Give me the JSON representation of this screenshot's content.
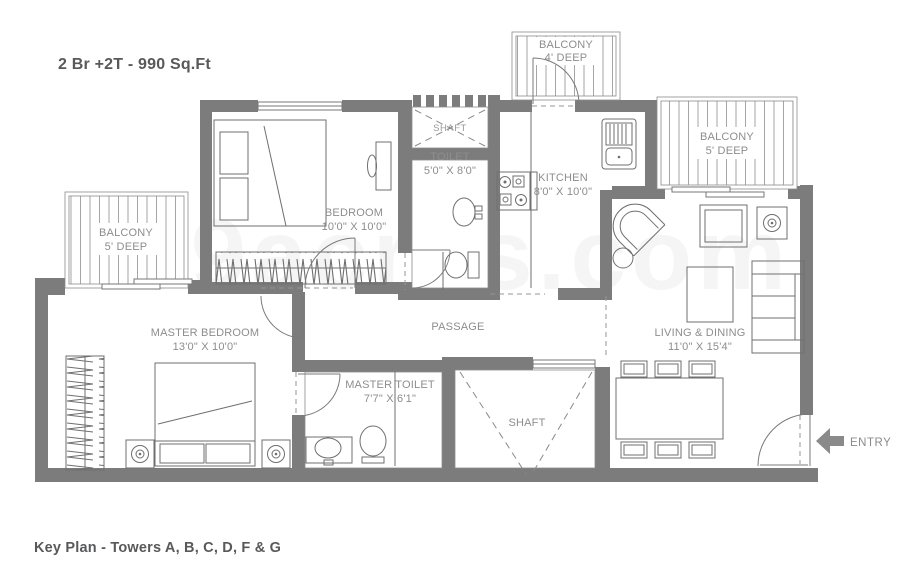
{
  "title": "2 Br +2T - 990 Sq.Ft",
  "footer": "Key Plan - Towers A, B, C, D, F & G",
  "watermark": "99acres.com",
  "entry": {
    "label": "ENTRY"
  },
  "rooms": {
    "bedroom": {
      "name": "BEDROOM",
      "dims": "10'0\" X 10'0\""
    },
    "toilet": {
      "name": "TOILET",
      "dims": "5'0\" X 8'0\""
    },
    "kitchen": {
      "name": "KITCHEN",
      "dims": "8'0\" X 10'0\""
    },
    "master_bedroom": {
      "name": "MASTER BEDROOM",
      "dims": "13'0\" X 10'0\""
    },
    "master_toilet": {
      "name": "MASTER TOILET",
      "dims": "7'7\" X 6'1\""
    },
    "living_dining": {
      "name": "LIVING & DINING",
      "dims": "11'0\" X 15'4\""
    },
    "balcony_top": {
      "name": "BALCONY",
      "dims": "4' DEEP"
    },
    "balcony_right": {
      "name": "BALCONY",
      "dims": "5' DEEP"
    },
    "balcony_left": {
      "name": "BALCONY",
      "dims": "5' DEEP"
    },
    "passage": {
      "name": "PASSAGE"
    },
    "shaft_upper": {
      "name": "SHAFT"
    },
    "shaft_lower": {
      "name": "SHAFT"
    }
  },
  "colors": {
    "wall": "#7c7c7c",
    "line": "#6f6f6f",
    "label": "#8d8d8d",
    "heading": "#58595b"
  }
}
